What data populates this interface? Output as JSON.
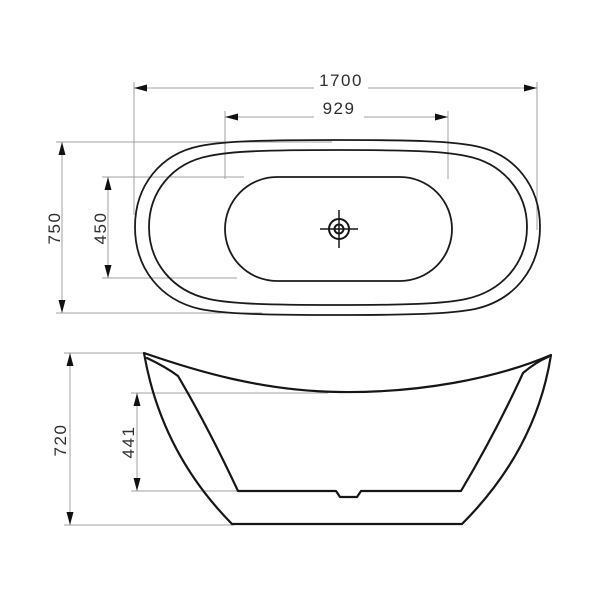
{
  "drawing": {
    "type": "technical-dimension-drawing",
    "subject": "freestanding-oval-bathtub",
    "background_color": "#ffffff",
    "colors": {
      "object_outline": "#1b1b1b",
      "dimension_lines": "#a0a0a0",
      "arrowheads": "#111111",
      "label_text": "#2e2e2e"
    },
    "top_view": {
      "description": "plan view of oval bathtub with rim, inner basin and drain symbol",
      "drain_symbol": "crosshair-target",
      "dimensions": {
        "overall_length": "1700",
        "inner_length": "929",
        "overall_width": "750",
        "inner_width": "450"
      }
    },
    "side_view": {
      "description": "side elevation of slipper-style bathtub with raised ends and drain notch",
      "dimensions": {
        "overall_height": "720",
        "inner_depth": "441"
      }
    }
  }
}
